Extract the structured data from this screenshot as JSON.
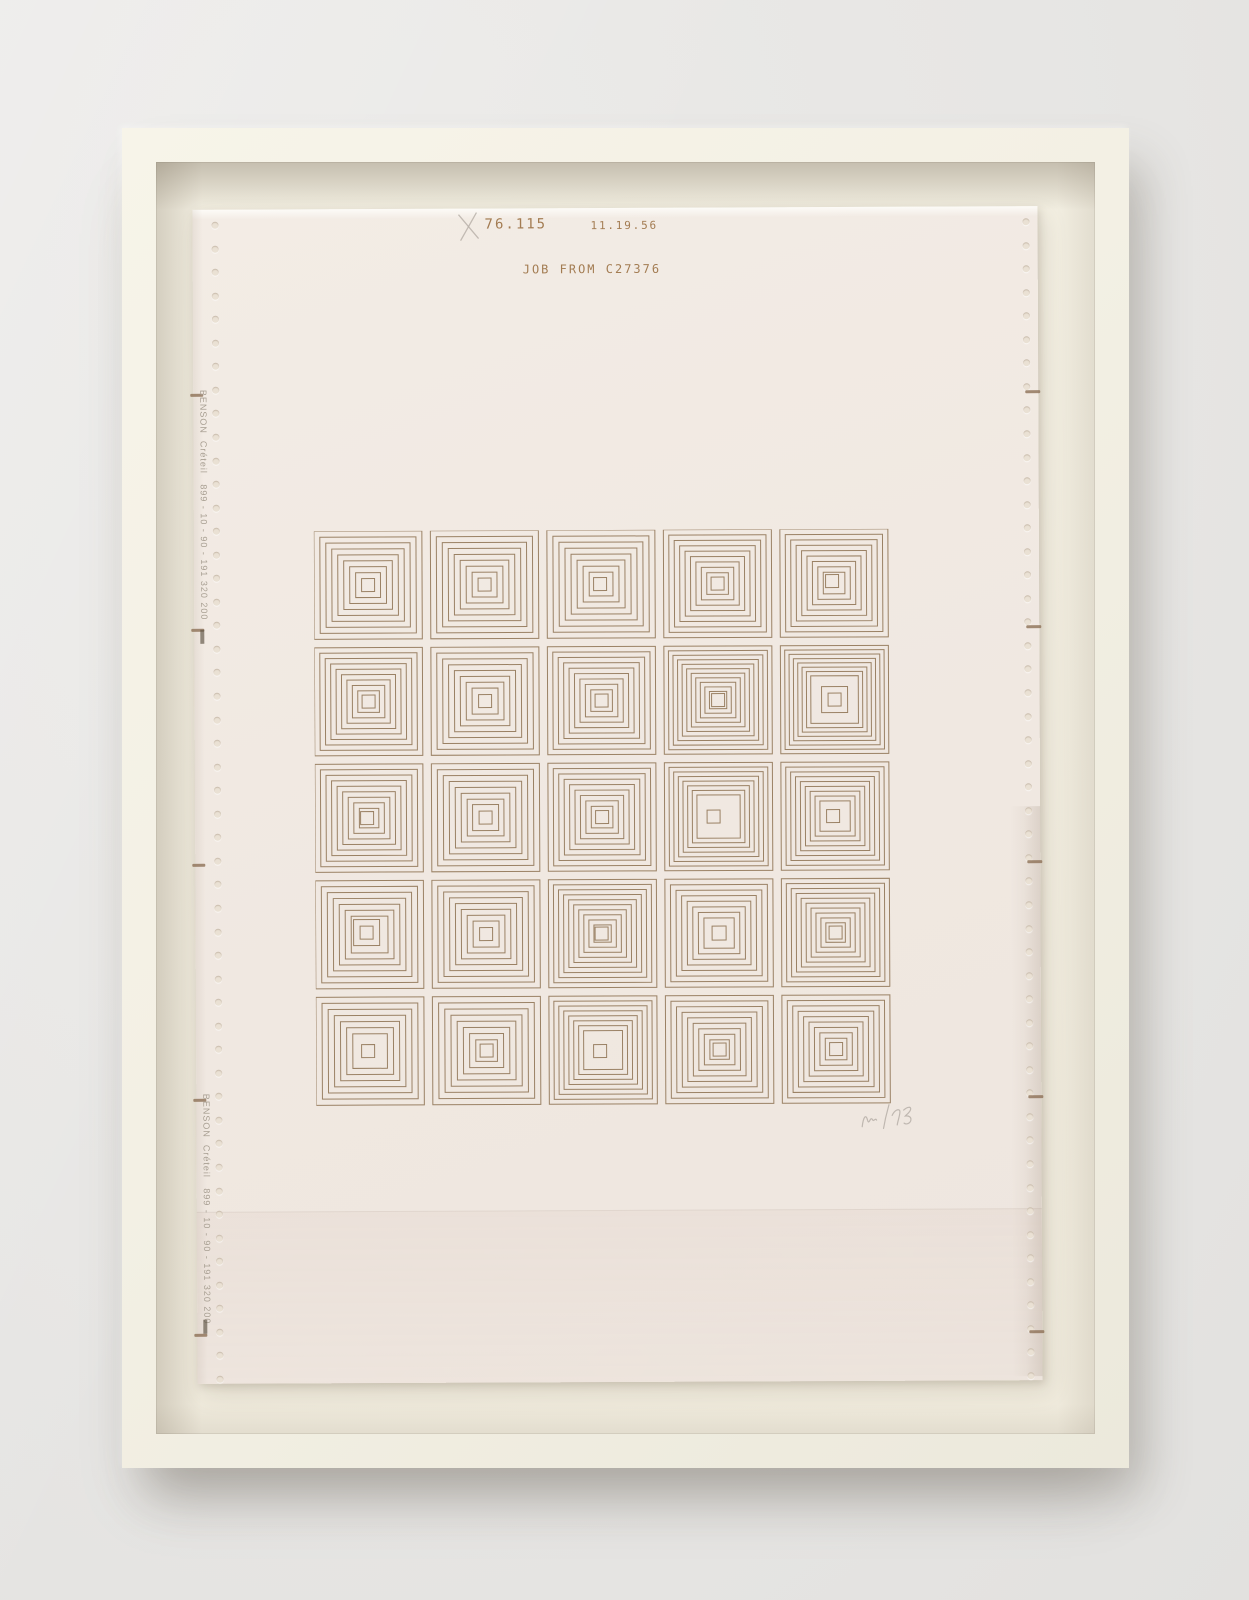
{
  "artwork": {
    "plot_header": {
      "catalog_number": "76.115",
      "date_code": "11.19.56",
      "job_line": "JOB FROM C27376",
      "pencil_mark": "X"
    },
    "edge_text": "BENSON  Créteil   899 - 10 - 90 - 191 320 200",
    "signature": "VM 76",
    "colors": {
      "ink": "#9a8164",
      "header_ink": "#a37c52",
      "edge_text_ink": "#a89f92",
      "fold_mark": "#8d7156",
      "pencil": "#b6afa7",
      "paper": "#f1e9e2",
      "frame": "#f3f0e4",
      "mat": "#f0ebde",
      "wall": "#e7e6e4"
    },
    "grid": {
      "rows": 5,
      "cols": 5,
      "cell_size": 108,
      "pitch": 116.5,
      "cell_params_legend": "[rings, depth_fraction, center_ring_side, center_square_side, center_dx, center_dy]",
      "cells": [
        [
          8,
          0.385,
          0,
          13,
          0,
          0
        ],
        [
          8,
          0.385,
          0,
          13,
          0,
          0
        ],
        [
          8,
          0.39,
          0,
          13,
          -1,
          0
        ],
        [
          9,
          0.4,
          0,
          13,
          0,
          0
        ],
        [
          9,
          0.4,
          0,
          13,
          -2,
          -2
        ],
        [
          9,
          0.4,
          0,
          13,
          0,
          0
        ],
        [
          8,
          0.38,
          0,
          13,
          0,
          0
        ],
        [
          9,
          0.4,
          0,
          13,
          0,
          0
        ],
        [
          11,
          0.42,
          0,
          13,
          0,
          0
        ],
        [
          8,
          0.28,
          26,
          13,
          0,
          0
        ],
        [
          9,
          0.41,
          0,
          13,
          -2,
          0
        ],
        [
          7,
          0.33,
          26,
          13,
          0,
          0
        ],
        [
          9,
          0.4,
          0,
          13,
          0,
          0
        ],
        [
          8,
          0.3,
          0,
          13,
          -5,
          0
        ],
        [
          9,
          0.36,
          0,
          13,
          -2,
          0
        ],
        [
          7,
          0.33,
          26,
          13,
          -3,
          -2
        ],
        [
          8,
          0.38,
          0,
          13,
          0,
          0
        ],
        [
          10,
          0.42,
          0,
          13,
          -1,
          0
        ],
        [
          8,
          0.36,
          0,
          14,
          0,
          0
        ],
        [
          10,
          0.41,
          0,
          13,
          0,
          0
        ],
        [
          7,
          0.34,
          0,
          13,
          -2,
          0
        ],
        [
          8,
          0.4,
          0,
          13,
          0,
          0
        ],
        [
          8,
          0.32,
          0,
          13,
          -3,
          1
        ],
        [
          9,
          0.41,
          0,
          13,
          0,
          0
        ],
        [
          9,
          0.4,
          0,
          13,
          0,
          0
        ]
      ]
    },
    "paper_marks": {
      "fold_mark_y": [
        184,
        419,
        654,
        889,
        1124
      ],
      "sprocket_holes_per_side": 50
    }
  }
}
